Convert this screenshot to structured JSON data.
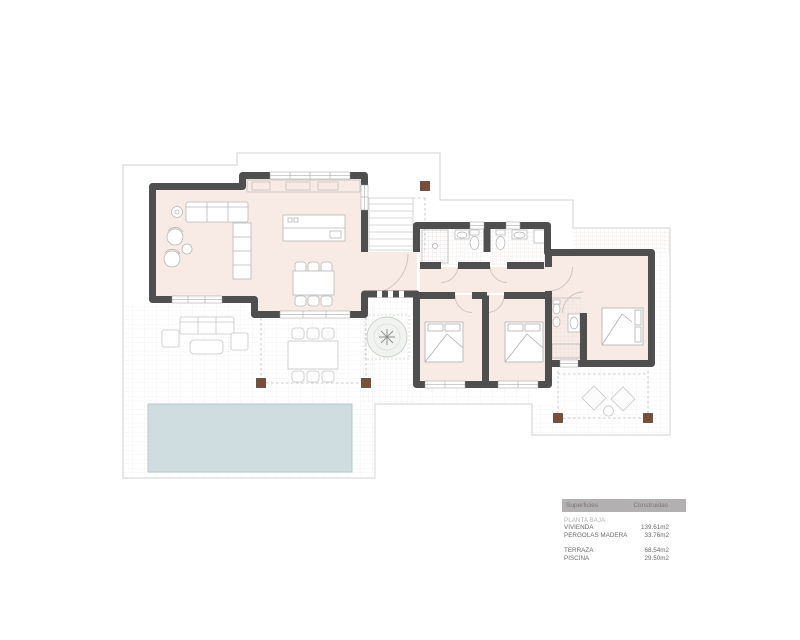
{
  "legend": {
    "header": {
      "surfaces": "Superficies",
      "built": "Construidas"
    },
    "floor_label": "PLANTA BAJA",
    "groups": [
      {
        "rows": [
          {
            "label": "VIVIENDA",
            "value": "139.61m2"
          },
          {
            "label": "PERGOLAS MADERA",
            "value": "33.76m2"
          }
        ]
      },
      {
        "rows": [
          {
            "label": "TERRAZA",
            "value": "68.54m2"
          },
          {
            "label": "PISCINA",
            "value": "29.50m2"
          }
        ]
      }
    ]
  },
  "colors": {
    "wall": "#4f4f4f",
    "room": "#f8ebe5",
    "pool": "#cfdde1",
    "pool_border": "#b9c7cc",
    "post": "#7d4e36",
    "terrace_line": "#d2d2d2",
    "legend_header_bg": "#b2b0b0"
  }
}
